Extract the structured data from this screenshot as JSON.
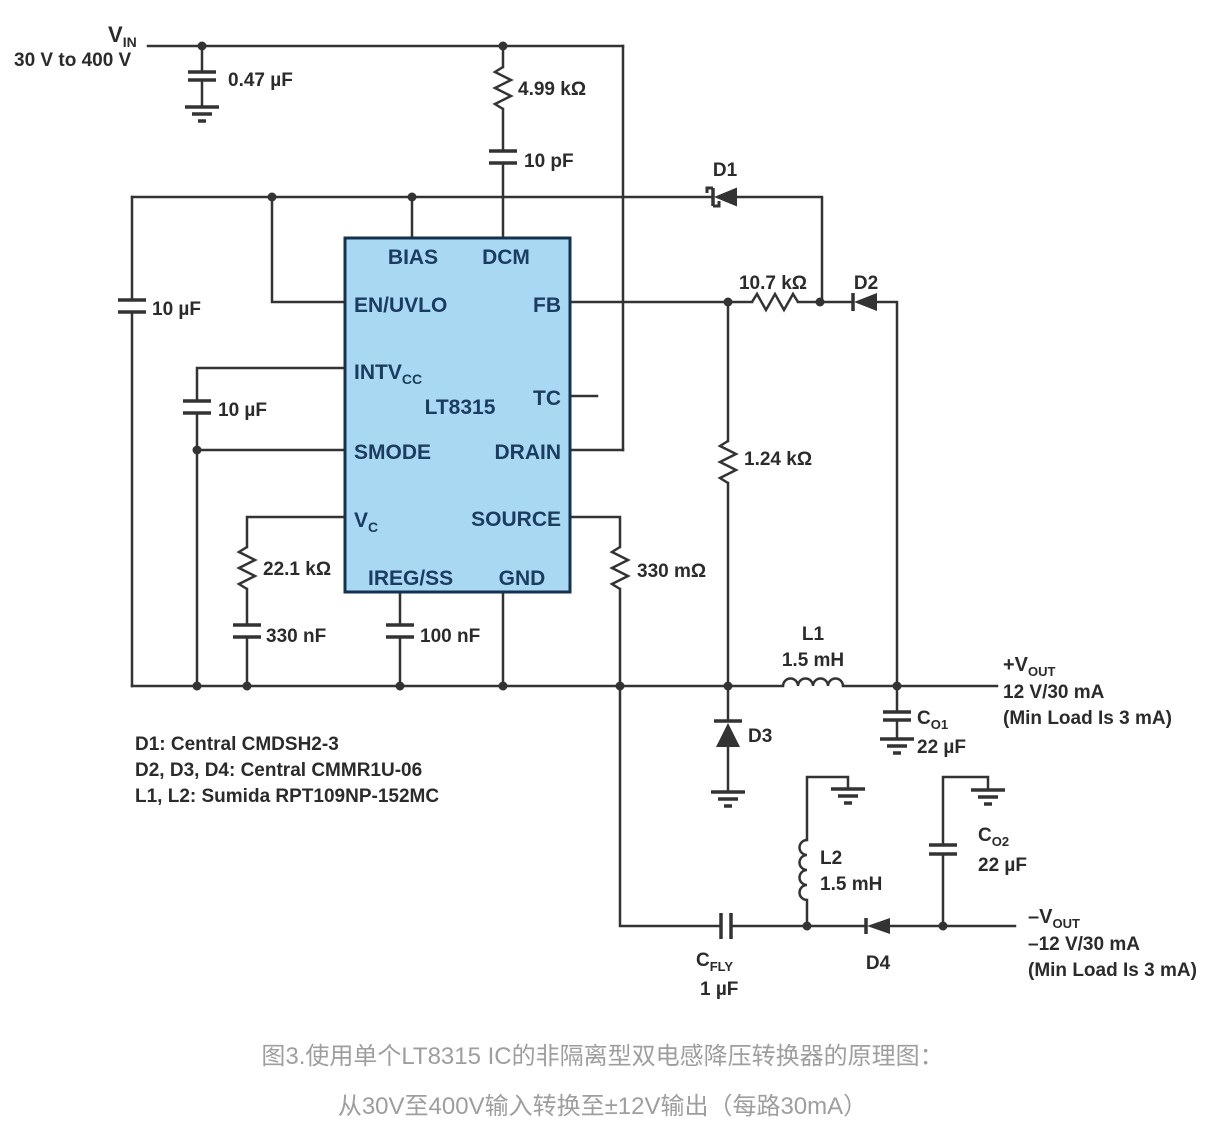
{
  "colors": {
    "wire": "#333333",
    "ic_fill": "#a9d9f2",
    "ic_stroke": "#14324f",
    "ic_text": "#1b3c5e",
    "label": "#2b2b2b",
    "caption_gray": "#9e9e9e"
  },
  "supply": {
    "v": "V",
    "v_sub": "IN",
    "range": "30 V to 400 V"
  },
  "ic": {
    "name": "LT8315",
    "bias": "BIAS",
    "dcm": "DCM",
    "en_uvlo": "EN/UVLO",
    "fb": "FB",
    "intv": "INTV",
    "intv_sub": "CC",
    "tc": "TC",
    "smode": "SMODE",
    "drain": "DRAIN",
    "vc": "V",
    "vc_sub": "C",
    "source": "SOURCE",
    "ireg_ss": "IREG/SS",
    "gnd": "GND"
  },
  "parts": {
    "cin": "0.47 µF",
    "rdcm": "4.99 kΩ",
    "cdcm": "10 pF",
    "cen": "10 µF",
    "cintv": "10 µF",
    "rfb": "10.7 kΩ",
    "rdiv": "1.24 kΩ",
    "rvc": "22.1 kΩ",
    "cvc": "330 nF",
    "css": "100 nF",
    "rsense": "330 mΩ",
    "d1": "D1",
    "d2": "D2",
    "d3": "D3",
    "d4": "D4",
    "l1": "L1",
    "l1_val": "1.5 mH",
    "l2": "L2",
    "l2_val": "1.5 mH",
    "co1": "C",
    "co1_sub": "O1",
    "co1_val": "22 µF",
    "co2": "C",
    "co2_sub": "O2",
    "co2_val": "22 µF",
    "cfly": "C",
    "cfly_sub": "FLY",
    "cfly_val": "1 µF"
  },
  "out_pos": {
    "v": "+V",
    "sub": "OUT",
    "rating": "12 V/30 mA",
    "note": "(Min Load Is 3 mA)"
  },
  "out_neg": {
    "v": "–V",
    "sub": "OUT",
    "rating": "–12 V/30 mA",
    "note": "(Min Load Is 3 mA)"
  },
  "notes": [
    "D1: Central CMDSH2-3",
    "D2, D3, D4: Central CMMR1U-06",
    "L1, L2: Sumida RPT109NP-152MC"
  ],
  "caption": {
    "line1": "图3.使用单个LT8315 IC的非隔离型双电感降压转换器的原理图：",
    "line2": "从30V至400V输入转换至±12V输出（每路30mA）"
  }
}
